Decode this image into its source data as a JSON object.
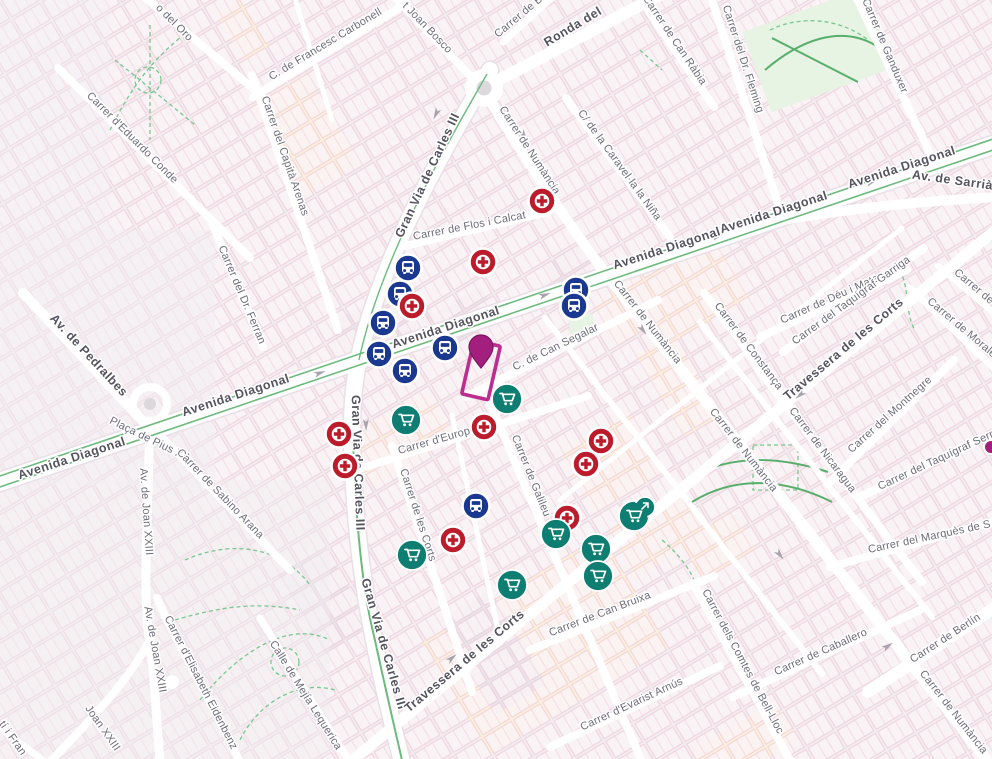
{
  "view": {
    "width": 992,
    "height": 759
  },
  "colors": {
    "bus_blue": "#1b3890",
    "pharmacy_red": "#bb1b2a",
    "supermarket_teal": "#0f7e72",
    "selected_magenta": "#a21f7d",
    "selected_pin_stroke": "#7c155f",
    "highlight_outline": "#bb2d8f",
    "background": "#f1eef0",
    "road_white": "#ffffff",
    "park_green": "#79c78f",
    "median_green": "#6cba7d"
  },
  "street_labels": [
    {
      "t": "Avenida Diagonal",
      "x": 903,
      "y": 171,
      "r": -18,
      "c": "major"
    },
    {
      "t": "Avenida Diagonal",
      "x": 775,
      "y": 216,
      "r": -18,
      "c": "major"
    },
    {
      "t": "Avenida Diagonal",
      "x": 668,
      "y": 252,
      "r": -18,
      "c": "major"
    },
    {
      "t": "Avenida Diagonal",
      "x": 447,
      "y": 331,
      "r": -18,
      "c": "major"
    },
    {
      "t": "Avenida Diagonal",
      "x": 237,
      "y": 399,
      "r": -18,
      "c": "major"
    },
    {
      "t": "Avenida Diagonal",
      "x": 73,
      "y": 462,
      "r": -18,
      "c": "major"
    },
    {
      "t": "Av. de Sarrià",
      "x": 952,
      "y": 184,
      "r": 8,
      "c": "major"
    },
    {
      "t": "Ronda del",
      "x": 575,
      "y": 30,
      "r": -31,
      "c": "major"
    },
    {
      "t": "Gran Via de Carles III",
      "x": 431,
      "y": 177,
      "r": -65,
      "c": "major"
    },
    {
      "t": "Gran Via de Carles III",
      "x": 354,
      "y": 463,
      "r": 88,
      "c": "major"
    },
    {
      "t": "Gran Via de Carles III",
      "x": 380,
      "y": 645,
      "r": 74,
      "c": "major"
    },
    {
      "t": "Travessera de les Corts",
      "x": 467,
      "y": 664,
      "r": -40,
      "c": "major"
    },
    {
      "t": "Travessera de les Corts",
      "x": 846,
      "y": 352,
      "r": -40,
      "c": "major"
    },
    {
      "t": "Av. de Pedralbes",
      "x": 86,
      "y": 358,
      "r": 47,
      "c": "major"
    },
    {
      "t": "o del Oro",
      "x": 172,
      "y": 25,
      "r": 45,
      "c": "minor"
    },
    {
      "t": "C. de Francesc Carbonell",
      "x": 327,
      "y": 47,
      "r": -31,
      "c": "minor"
    },
    {
      "t": "t Joan Bosco",
      "x": 425,
      "y": 30,
      "r": 46,
      "c": "minor"
    },
    {
      "t": "Carrer de Bu",
      "x": 523,
      "y": 17,
      "r": -40,
      "c": "minor"
    },
    {
      "t": "Carrer de Can Ràbia",
      "x": 672,
      "y": 42,
      "r": 56,
      "c": "minor"
    },
    {
      "t": "Carrer del Dr. Fleming",
      "x": 740,
      "y": 60,
      "r": 72,
      "c": "minor"
    },
    {
      "t": "Carrer de Ganduxer",
      "x": 882,
      "y": 47,
      "r": 67,
      "c": "minor"
    },
    {
      "t": "Carrer d'Eduardo Conde",
      "x": 130,
      "y": 140,
      "r": 45,
      "c": "minor"
    },
    {
      "t": "Carrer del Capità Arenas",
      "x": 282,
      "y": 157,
      "r": 71,
      "c": "minor"
    },
    {
      "t": "Carrer de Numància",
      "x": 527,
      "y": 152,
      "r": 57,
      "c": "minor"
    },
    {
      "t": "C/ de la Caravel·la la Niña",
      "x": 617,
      "y": 167,
      "r": 54,
      "c": "minor"
    },
    {
      "t": "Carrer de Flos i Calcat",
      "x": 470,
      "y": 229,
      "r": -11,
      "c": "minor"
    },
    {
      "t": "Carrer del Dr. Ferran",
      "x": 239,
      "y": 296,
      "r": 67,
      "c": "minor"
    },
    {
      "t": "Plaça de Pius XII",
      "x": 148,
      "y": 442,
      "r": 26,
      "c": "minor"
    },
    {
      "t": "Carrer de Sabino Arana",
      "x": 218,
      "y": 496,
      "r": 46,
      "c": "minor"
    },
    {
      "t": "Av. de Joan XXIII",
      "x": 143,
      "y": 512,
      "r": 86,
      "c": "minor"
    },
    {
      "t": "Av. de Joan XXIII",
      "x": 152,
      "y": 650,
      "r": 80,
      "c": "minor"
    },
    {
      "t": "Joan XXIII",
      "x": 100,
      "y": 730,
      "r": 55,
      "c": "minor"
    },
    {
      "t": "Carrer d'Elisabeth Eidenbenz",
      "x": 198,
      "y": 684,
      "r": 63,
      "c": "minor"
    },
    {
      "t": "Calle de Mejía Lequerica",
      "x": 303,
      "y": 697,
      "r": 58,
      "c": "minor"
    },
    {
      "t": "tí i Fran",
      "x": 10,
      "y": 740,
      "r": 55,
      "c": "minor"
    },
    {
      "t": "C. de Can Segalar",
      "x": 557,
      "y": 350,
      "r": -26,
      "c": "minor"
    },
    {
      "t": "Carrer d'Europa",
      "x": 438,
      "y": 443,
      "r": -16,
      "c": "minor"
    },
    {
      "t": "Carrer de Galileu",
      "x": 528,
      "y": 477,
      "r": 68,
      "c": "minor"
    },
    {
      "t": "Carrer de les Corts",
      "x": 415,
      "y": 516,
      "r": 72,
      "c": "minor"
    },
    {
      "t": "Carrer de Numància",
      "x": 645,
      "y": 324,
      "r": 52,
      "c": "minor"
    },
    {
      "t": "Carrer de Numància",
      "x": 741,
      "y": 452,
      "r": 52,
      "c": "minor"
    },
    {
      "t": "Carrer de Numància",
      "x": 951,
      "y": 714,
      "r": 52,
      "c": "minor"
    },
    {
      "t": "Carrer de Constança",
      "x": 746,
      "y": 348,
      "r": 53,
      "c": "minor"
    },
    {
      "t": "Carrer de Déu i Mata",
      "x": 831,
      "y": 302,
      "r": -24,
      "c": "minor"
    },
    {
      "t": "Carrer del Taquígraf Garriga",
      "x": 853,
      "y": 303,
      "r": -36,
      "c": "minor"
    },
    {
      "t": "Carrer de Nicaragua",
      "x": 820,
      "y": 452,
      "r": 53,
      "c": "minor"
    },
    {
      "t": "Carrer del Montnegre",
      "x": 892,
      "y": 417,
      "r": -42,
      "c": "minor"
    },
    {
      "t": "Carrer de Morales",
      "x": 962,
      "y": 332,
      "r": 40,
      "c": "minor"
    },
    {
      "t": "Carrer de",
      "x": 972,
      "y": 289,
      "r": 40,
      "c": "minor"
    },
    {
      "t": "Carrer del Taquígraf Serra",
      "x": 940,
      "y": 462,
      "r": -25,
      "c": "minor"
    },
    {
      "t": "Carrer de Can Bruixa",
      "x": 601,
      "y": 617,
      "r": -21,
      "c": "minor"
    },
    {
      "t": "Carrer d'Evarist Arnús",
      "x": 633,
      "y": 707,
      "r": -25,
      "c": "minor"
    },
    {
      "t": "Carrer de Caballero",
      "x": 822,
      "y": 655,
      "r": -24,
      "c": "minor"
    },
    {
      "t": "Carrer del Marquès de S",
      "x": 930,
      "y": 540,
      "r": -12,
      "c": "minor"
    },
    {
      "t": "Carrer dels Comtes de Bell-Lloc",
      "x": 740,
      "y": 663,
      "r": 62,
      "c": "minor"
    },
    {
      "t": "Carrer de Berlín",
      "x": 947,
      "y": 641,
      "r": -33,
      "c": "minor"
    }
  ],
  "markers": {
    "bus_stops": {
      "icon": "bus-icon",
      "color": "#1b3890",
      "positions": [
        [
          408,
          268
        ],
        [
          400,
          294
        ],
        [
          383,
          323
        ],
        [
          379,
          354
        ],
        [
          445,
          348
        ],
        [
          405,
          371
        ],
        [
          576,
          290
        ],
        [
          574,
          306
        ],
        [
          476,
          506
        ]
      ]
    },
    "pharmacies": {
      "icon": "medical-cross-icon",
      "color": "#bb1b2a",
      "positions": [
        [
          542,
          201
        ],
        [
          483,
          262
        ],
        [
          412,
          306
        ],
        [
          339,
          434
        ],
        [
          345,
          466
        ],
        [
          484,
          427
        ],
        [
          601,
          441
        ],
        [
          586,
          464
        ],
        [
          567,
          518
        ],
        [
          453,
          540
        ]
      ]
    },
    "supermarkets": {
      "icon": "shopping-cart-icon",
      "color": "#0f7e72",
      "positions": [
        [
          507,
          399
        ],
        [
          406,
          420
        ],
        [
          412,
          555
        ],
        [
          556,
          534
        ],
        [
          596,
          549
        ],
        [
          598,
          576
        ],
        [
          512,
          585
        ]
      ]
    },
    "supermarket_cluster": {
      "icon": "shopping-cart-arrow-icon",
      "color": "#0f7e72",
      "x": 634,
      "y": 516
    },
    "selected_place": {
      "pin_color": "#a21f7d",
      "pin_stroke": "#7c155f",
      "outline_color": "#bb2d8f",
      "pin_x": 481,
      "pin_y": 351,
      "highlight": {
        "cx": 481,
        "cy": 370,
        "w": 27,
        "h": 55,
        "rotate": 13
      }
    },
    "partial_edge_marker": {
      "color": "#a21f7d",
      "x": 991,
      "y": 447
    }
  }
}
